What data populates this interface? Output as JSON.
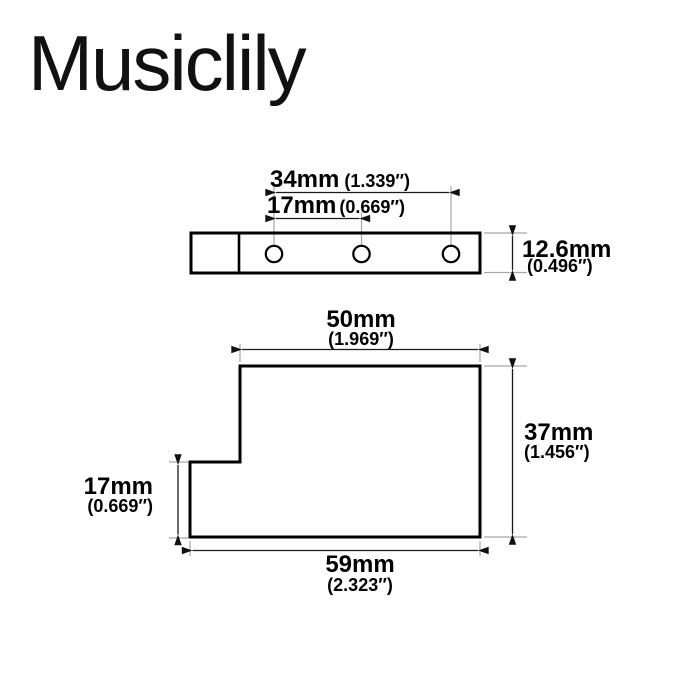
{
  "brand": {
    "logo_text": "Musiclily"
  },
  "colors": {
    "background": "#ffffff",
    "outline": "#000000",
    "dimension_line": "#1a1a1a",
    "extension_line": "#a6a6a6",
    "text": "#000000"
  },
  "top_view": {
    "description": "top view of mounting plate with 3 screw holes",
    "hole_count": 3,
    "dim_hole_span_outer": {
      "mm": "34mm",
      "inch": "(1.339″)"
    },
    "dim_hole_span_inner": {
      "mm": "17mm",
      "inch": "(0.669″)"
    },
    "dim_height": {
      "mm": "12.6mm",
      "inch": "(0.496″)"
    }
  },
  "side_view": {
    "description": "side profile of bracket with stepped notch",
    "dim_top_width": {
      "mm": "50mm",
      "inch": "(1.969″)"
    },
    "dim_height": {
      "mm": "37mm",
      "inch": "(1.456″)"
    },
    "dim_notch_height": {
      "mm": "17mm",
      "inch": "(0.669″)"
    },
    "dim_bottom_width": {
      "mm": "59mm",
      "inch": "(2.323″)"
    }
  }
}
